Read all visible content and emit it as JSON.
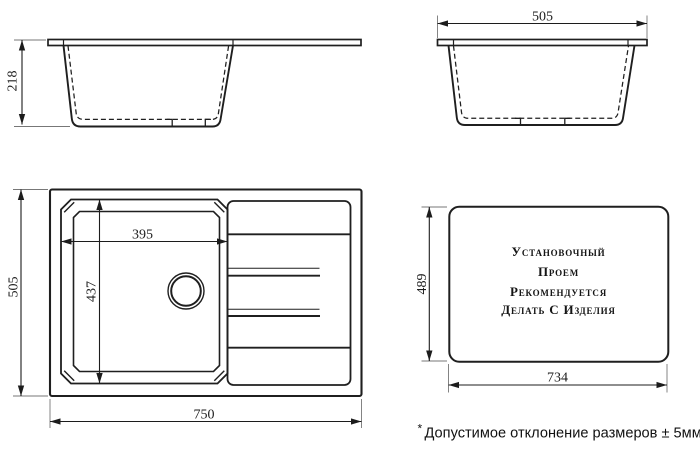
{
  "drawing": {
    "front_view": {
      "height": "218"
    },
    "side_view": {
      "width": "505"
    },
    "top_view": {
      "width": "750",
      "depth": "505",
      "bowl_width": "395",
      "bowl_depth": "437"
    },
    "cutout_view": {
      "width": "734",
      "height": "489",
      "note_line1": "Установочный",
      "note_line2": "Проем",
      "note_line3": "Рекомендуется",
      "note_line4": "Делать С Изделия"
    },
    "footnote": {
      "marker": "*",
      "text": "Допустимое отклонение размеров ± 5мм"
    }
  },
  "colors": {
    "line": "#1f1f1f",
    "background": "#ffffff"
  }
}
